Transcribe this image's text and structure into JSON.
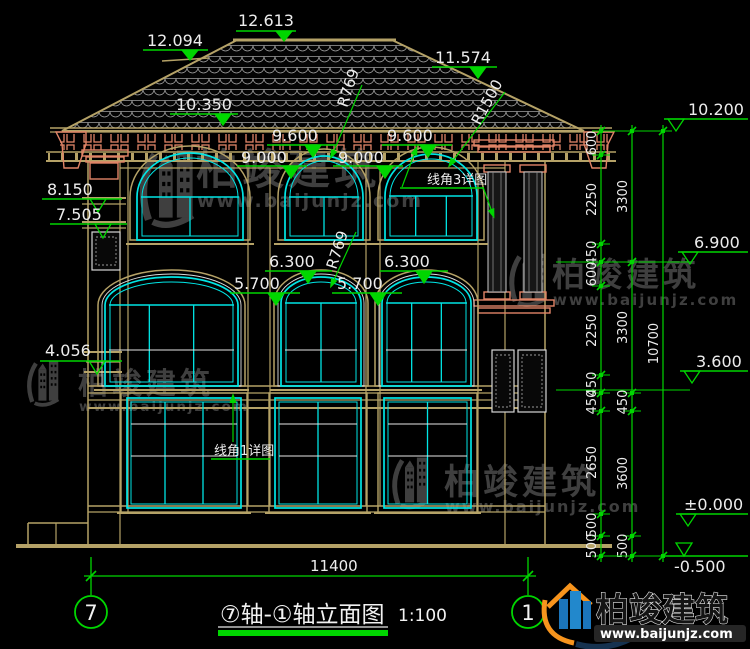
{
  "drawing_title": {
    "text": "⑦轴-①轴立面图",
    "scale": "1:100"
  },
  "axis_bubbles": {
    "left": "7",
    "right": "1"
  },
  "bottom_dimension": {
    "label": "11400",
    "x1": 91,
    "x2": 528,
    "y": 576
  },
  "watermark": {
    "brand": "柏竣建筑",
    "url": "www.baijunjz.com"
  },
  "logo": {
    "brand": "柏竣建筑",
    "url": "www.baijunjz.com"
  },
  "colors": {
    "green": "#00d600",
    "tan": "#b5a267",
    "cyan": "#00e5e5",
    "salmon": "#e08467",
    "white": "#ededed",
    "wm_gray": "#474747",
    "logo_orange": "#f7941d",
    "logo_blue": "#1b75bb"
  },
  "spot_elevations": [
    {
      "label": "12.613",
      "tx": 238,
      "ty": 26,
      "lx1": 236,
      "lx2": 296,
      "ly": 31,
      "ax": 284,
      "ay": 41,
      "style": "filled"
    },
    {
      "label": "12.094",
      "tx": 147,
      "ty": 46,
      "lx1": 143,
      "lx2": 208,
      "ly": 50,
      "ax": 190,
      "ay": 60,
      "style": "filled"
    },
    {
      "label": "11.574",
      "tx": 435,
      "ty": 63,
      "lx1": 432,
      "lx2": 497,
      "ly": 67,
      "ax": 478,
      "ay": 78,
      "style": "filled"
    },
    {
      "label": "10.350",
      "tx": 176,
      "ty": 110,
      "lx1": 170,
      "lx2": 238,
      "ly": 114,
      "ax": 223,
      "ay": 125,
      "style": "filled"
    },
    {
      "label": "9.600",
      "tx": 272,
      "ty": 141,
      "lx1": 267,
      "lx2": 337,
      "ly": 145,
      "ax": 313,
      "ay": 157,
      "style": "filled"
    },
    {
      "label": "9.600",
      "tx": 387,
      "ty": 141,
      "lx1": 382,
      "lx2": 452,
      "ly": 145,
      "ax": 428,
      "ay": 157,
      "style": "filled"
    },
    {
      "label": "9.000",
      "tx": 241,
      "ty": 163,
      "lx1": 237,
      "lx2": 307,
      "ly": 166,
      "ax": 291,
      "ay": 178,
      "style": "filled"
    },
    {
      "label": "9.000",
      "tx": 338,
      "ty": 163,
      "lx1": 333,
      "lx2": 403,
      "ly": 166,
      "ax": 385,
      "ay": 178,
      "style": "filled"
    },
    {
      "label": "6.300",
      "tx": 269,
      "ty": 267,
      "lx1": 265,
      "lx2": 332,
      "ly": 271,
      "ax": 308,
      "ay": 283,
      "style": "filled"
    },
    {
      "label": "6.300",
      "tx": 384,
      "ty": 267,
      "lx1": 380,
      "lx2": 448,
      "ly": 271,
      "ax": 424,
      "ay": 283,
      "style": "filled"
    },
    {
      "label": "5.700",
      "tx": 234,
      "ty": 289,
      "lx1": 230,
      "lx2": 300,
      "ly": 293,
      "ax": 276,
      "ay": 305,
      "style": "filled"
    },
    {
      "label": "5.700",
      "tx": 337,
      "ty": 289,
      "lx1": 332,
      "lx2": 402,
      "ly": 293,
      "ax": 378,
      "ay": 305,
      "style": "filled"
    },
    {
      "label": "8.150",
      "tx": 47,
      "ty": 195,
      "lx1": 42,
      "lx2": 122,
      "ly": 199,
      "ax": 98,
      "ay": 212,
      "style": "open"
    },
    {
      "label": "7.505",
      "tx": 56,
      "ty": 220,
      "lx1": 50,
      "lx2": 127,
      "ly": 224,
      "ax": 103,
      "ay": 238,
      "style": "open"
    },
    {
      "label": "4.056",
      "tx": 45,
      "ty": 356,
      "lx1": 40,
      "lx2": 122,
      "ly": 361,
      "ax": 97,
      "ay": 374,
      "style": "open"
    },
    {
      "label": "10.200",
      "tx": 688,
      "ty": 115,
      "lx1": 664,
      "lx2": 748,
      "ly": 119,
      "ax": 676,
      "ay": 131,
      "style": "open"
    },
    {
      "label": "6.900",
      "tx": 694,
      "ty": 248,
      "lx1": 678,
      "lx2": 748,
      "ly": 252,
      "ax": 690,
      "ay": 264,
      "style": "open"
    },
    {
      "label": "3.600",
      "tx": 696,
      "ty": 367,
      "lx1": 680,
      "lx2": 748,
      "ly": 371,
      "ax": 692,
      "ay": 383,
      "style": "open"
    },
    {
      "label": "±0.000",
      "tx": 684,
      "ty": 510,
      "lx1": 676,
      "lx2": 748,
      "ly": 514,
      "ax": 688,
      "ay": 526,
      "style": "open"
    },
    {
      "label": "-0.500",
      "tx": 674,
      "ty": 572,
      "lx1": 664,
      "lx2": 748,
      "ly": 556,
      "ax": 684,
      "ay": 556,
      "style": "open-above"
    }
  ],
  "radius_labels": [
    {
      "label": "R769",
      "x": 347,
      "y": 108,
      "rot": -72,
      "leader": [
        333,
        153,
        362,
        85
      ],
      "arot": 205
    },
    {
      "label": "R1500",
      "x": 480,
      "y": 126,
      "rot": -62,
      "leader": [
        452,
        162,
        505,
        92
      ],
      "arot": 215
    },
    {
      "label": "R769",
      "x": 336,
      "y": 270,
      "rot": -72,
      "leader": [
        333,
        282,
        356,
        232
      ],
      "arot": 205
    }
  ],
  "detail_labels": [
    {
      "label": "线角3详图",
      "tx": 427,
      "ty": 184,
      "ux1": 400,
      "ux2": 483,
      "uy": 188,
      "leaders": [
        [
          402,
          187,
          415,
          152,
          20
        ],
        [
          483,
          187,
          492,
          212,
          160
        ]
      ]
    },
    {
      "label": "线角1详图",
      "tx": 214,
      "ty": 455,
      "ux1": 211,
      "ux2": 270,
      "uy": 459,
      "leaders": [
        [
          233,
          442,
          233,
          400,
          0
        ]
      ]
    }
  ],
  "dim_chains": [
    {
      "x": 601,
      "ticks": [
        131,
        155,
        244,
        262,
        286,
        375,
        393,
        411,
        514,
        536,
        556
      ],
      "labels": [
        "600",
        "2250",
        "450",
        "600",
        "2250",
        "450",
        "450",
        "2650",
        "500",
        "500"
      ]
    },
    {
      "x": 632,
      "ticks": [
        131,
        262,
        393,
        411,
        536,
        556
      ],
      "labels": [
        "3300",
        "3300",
        "450",
        "3600",
        "500"
      ]
    },
    {
      "x": 663,
      "ticks": [
        131,
        556
      ],
      "labels": [
        "10700"
      ]
    }
  ],
  "connectors": [
    [
      600,
      131,
      664,
      131
    ],
    [
      556,
      262,
      688,
      262
    ],
    [
      556,
      390,
      690,
      390
    ],
    [
      601,
      556,
      670,
      556
    ]
  ],
  "geometry": {
    "roof": {
      "outline": [
        [
          62,
          131
        ],
        [
          237,
          40
        ],
        [
          392,
          40
        ],
        [
          584,
          131
        ]
      ],
      "ridge": [
        233,
        40,
        396,
        40
      ],
      "break_line": [
        162,
        61,
        209,
        58
      ]
    },
    "tan_lines": [
      [
        50,
        128,
        612,
        128,
        1.5
      ],
      [
        50,
        132,
        612,
        132,
        1.2
      ],
      [
        46,
        152,
        616,
        152,
        1.5
      ],
      [
        46,
        161,
        616,
        161,
        2
      ],
      [
        120,
        168,
        505,
        168,
        1.2
      ],
      [
        88,
        161,
        88,
        547,
        1.5
      ],
      [
        120,
        161,
        120,
        547,
        1.2
      ],
      [
        128,
        161,
        128,
        512,
        1.2
      ],
      [
        478,
        161,
        478,
        512,
        1.2
      ],
      [
        505,
        161,
        505,
        547,
        1.2
      ],
      [
        545,
        161,
        545,
        547,
        1.5
      ],
      [
        248,
        168,
        248,
        506,
        1.2
      ],
      [
        270,
        168,
        270,
        506,
        1.2
      ],
      [
        366,
        168,
        366,
        506,
        1.2
      ],
      [
        380,
        168,
        380,
        506,
        1.2
      ],
      [
        88,
        386,
        545,
        386,
        1.5
      ],
      [
        88,
        393,
        545,
        393,
        1.2
      ],
      [
        88,
        400,
        545,
        400,
        1.2
      ],
      [
        88,
        408,
        545,
        408,
        2
      ],
      [
        88,
        506,
        545,
        506,
        1.5
      ],
      [
        88,
        512,
        545,
        512,
        1.2
      ],
      [
        16,
        546,
        612,
        546,
        4
      ],
      [
        28,
        523,
        88,
        523,
        1.5
      ],
      [
        28,
        523,
        28,
        546,
        1.5
      ],
      [
        56,
        523,
        56,
        546,
        1.2
      ],
      [
        82,
        198,
        126,
        198,
        2
      ],
      [
        82,
        204,
        126,
        204,
        1.2
      ],
      [
        82,
        222,
        126,
        222,
        2
      ],
      [
        82,
        228,
        126,
        228,
        1.2
      ],
      [
        84,
        352,
        122,
        352,
        2
      ],
      [
        86,
        362,
        120,
        362,
        1.2
      ],
      [
        84,
        372,
        122,
        372,
        2
      ]
    ],
    "salmon_rects": [
      [
        82,
        150,
        46,
        6
      ],
      [
        86,
        157,
        38,
        5
      ],
      [
        90,
        163,
        28,
        16
      ],
      [
        474,
        140,
        80,
        6
      ],
      [
        478,
        147,
        72,
        5
      ],
      [
        484,
        165,
        26,
        7
      ],
      [
        520,
        165,
        26,
        7
      ],
      [
        484,
        292,
        26,
        7
      ],
      [
        520,
        292,
        26,
        7
      ],
      [
        474,
        300,
        80,
        6
      ],
      [
        478,
        308,
        72,
        5
      ]
    ],
    "salmon_paths": [
      "M56,132 h30 v12 l-8,24 h-14 l-2,-24 z",
      "M614,132 h-30 v12 l8,24 h14 l2,-24 z"
    ],
    "balusters": [
      [
        488,
        172,
        18,
        120
      ],
      [
        524,
        172,
        18,
        120
      ]
    ],
    "ornament_panels": [
      [
        92,
        232,
        28,
        38
      ],
      [
        492,
        350,
        22,
        62
      ],
      [
        518,
        350,
        28,
        62
      ]
    ],
    "dentil_strip": [
      60,
      134,
      548,
      16
    ],
    "windows": {
      "top": [
        {
          "x": 137,
          "w": 106,
          "apex": 153,
          "spring": 197,
          "bottom": 240,
          "verts": 1,
          "rows": []
        },
        {
          "x": 285,
          "w": 78,
          "apex": 156,
          "spring": 197,
          "bottom": 240,
          "verts": 1,
          "rows": []
        },
        {
          "x": 385,
          "w": 92,
          "apex": 154,
          "spring": 196,
          "bottom": 240,
          "verts": 2,
          "rows": []
        }
      ],
      "mid": [
        {
          "x": 105,
          "w": 133,
          "apex": 277,
          "spring": 305,
          "bottom": 386,
          "verts": 2,
          "rows": [
            350
          ]
        },
        {
          "x": 281,
          "w": 80,
          "apex": 277,
          "spring": 303,
          "bottom": 386,
          "verts": 1,
          "rows": [
            350
          ]
        },
        {
          "x": 382,
          "w": 89,
          "apex": 277,
          "spring": 303,
          "bottom": 386,
          "verts": 2,
          "rows": [
            350
          ]
        }
      ],
      "ground": [
        {
          "x": 127,
          "w": 114,
          "top": 398,
          "bottom": 508,
          "verts": 2,
          "rows": [
            424,
            456
          ]
        },
        {
          "x": 275,
          "w": 86,
          "top": 398,
          "bottom": 508,
          "verts": 1,
          "rows": [
            424,
            456
          ]
        },
        {
          "x": 384,
          "w": 87,
          "top": 398,
          "bottom": 508,
          "verts": 1,
          "rows": [
            424,
            456
          ]
        }
      ]
    }
  },
  "watermark_instances": [
    {
      "ix": 138,
      "iy": 142,
      "is": 1.05,
      "tx": 196,
      "ty": 184,
      "fs": 42,
      "ux": 197,
      "uy": 207,
      "ufs": 19
    },
    {
      "ix": 508,
      "iy": 248,
      "is": 0.72,
      "tx": 552,
      "ty": 286,
      "fs": 33,
      "ux": 553,
      "uy": 305,
      "ufs": 15
    },
    {
      "ix": 26,
      "iy": 356,
      "is": 0.62,
      "tx": 78,
      "ty": 394,
      "fs": 30,
      "ux": 79,
      "uy": 411,
      "ufs": 13.5
    },
    {
      "ix": 391,
      "iy": 452,
      "is": 0.7,
      "tx": 444,
      "ty": 494,
      "fs": 35,
      "ux": 445,
      "uy": 512,
      "ufs": 16
    }
  ]
}
